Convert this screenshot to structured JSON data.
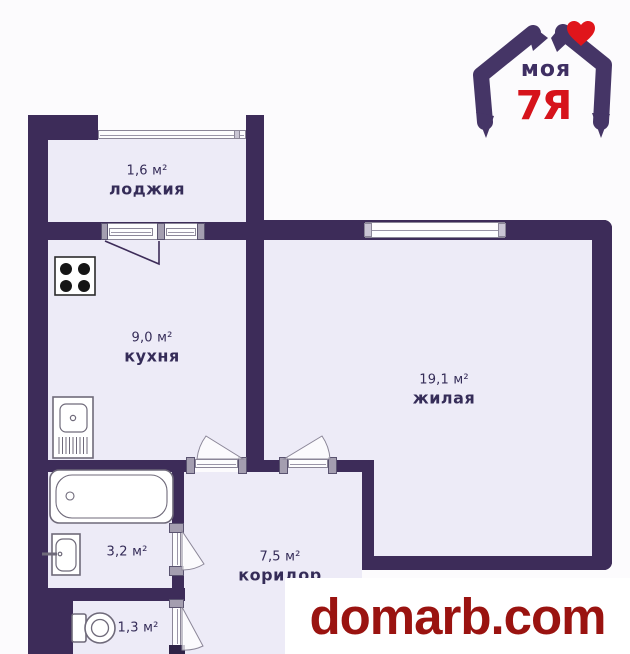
{
  "plan_title": "one-room apartment floor plan",
  "rooms": [
    {
      "id": "loggia",
      "name": "лоджия",
      "area": "1,6 м²"
    },
    {
      "id": "kitchen",
      "name": "кухня",
      "area": "9,0 м²"
    },
    {
      "id": "living",
      "name": "жилая",
      "area": "19,1 м²"
    },
    {
      "id": "corridor",
      "name": "коридор",
      "area": "7,5 м²"
    },
    {
      "id": "bathroom",
      "name": "",
      "area": "3,2 м²"
    },
    {
      "id": "wc",
      "name": "",
      "area": "1,3 м²"
    }
  ],
  "logo": {
    "brand_line1": "моя",
    "brand_line2": "7Я",
    "purple": "#453566",
    "red": "#d6131b",
    "heart_color": "#e0151b"
  },
  "watermark": {
    "text": "domarb.com",
    "color": "#9a1310"
  },
  "colors": {
    "wall": "#3d2c59",
    "room_fill": "#edebf7",
    "background": "#fcfbfd",
    "label_text": "#352c58",
    "door_post": "#a49eb0"
  },
  "icons": {
    "stove-icon": "white square with 4 black burner dots",
    "kitchen-sink-icon": "basin with drainboard hatching",
    "bathtub-icon": "rounded rectangle tub with drain",
    "washbasin-icon": "small basin with tap",
    "toilet-icon": "tank and round bowl",
    "heart-icon": "red heart",
    "house-arms-icon": "two arms forming a house roof"
  }
}
